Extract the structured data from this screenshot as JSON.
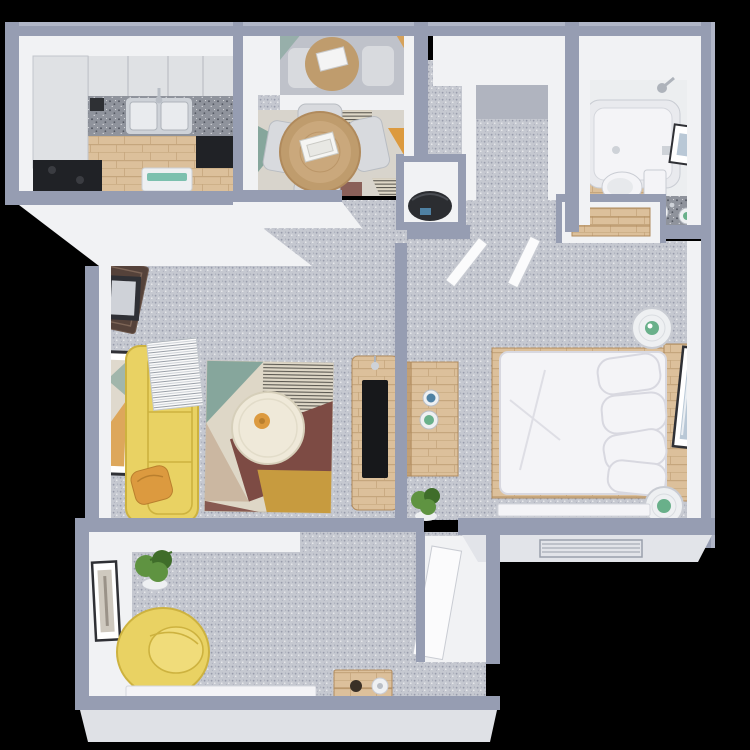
{
  "scene": {
    "title": "Top-down 3D render of a one-bedroom apartment floor plan on a black background",
    "view": "3D dollhouse / top-down",
    "rooms": [
      {
        "name": "Kitchen",
        "floor": "wood",
        "furniture": [
          "upper cabinets",
          "tall cabinet",
          "granite countertop",
          "double stainless sink with faucet",
          "black range",
          "black dishwasher",
          "white bench with teal accent"
        ]
      },
      {
        "name": "Dining Nook",
        "floor": "carpet with wood border",
        "furniture": [
          "round rattan dining table",
          "white books on table",
          "four light gray chairs",
          "geometric flat-weave rug",
          "wall mirror reflecting the dining set"
        ]
      },
      {
        "name": "Hall / Walk-in Closet",
        "floor": "carpet",
        "furniture": [
          "walk-in closet opening",
          "utility closet with dark water heater"
        ]
      },
      {
        "name": "Bathroom",
        "floor": "white with wood section",
        "furniture": [
          "bathtub",
          "shower head",
          "toilet",
          "granite vanity with two green-bowl sinks",
          "vanity lights",
          "framed artwork"
        ]
      },
      {
        "name": "Living Room",
        "floor": "carpet",
        "furniture": [
          "yellow sofa",
          "white striped throw blanket",
          "orange accent pillow",
          "geometric area rug",
          "round cream coffee table with orange decor",
          "wood TV stand with flat TV and candlestick",
          "open entry door",
          "dark welcome mat",
          "two framed artworks"
        ]
      },
      {
        "name": "Bedroom",
        "floor": "carpet",
        "furniture": [
          "white double bed with wood frame and headboard",
          "white pillows",
          "round nightstand with plant (top)",
          "round nightstand with plant (bottom)",
          "wood dresser with blue and green cups",
          "potted plant",
          "tilted framed artwork",
          "two open white doors",
          "closet with wood shelves",
          "white baseboard heater",
          "exterior wall vent"
        ]
      },
      {
        "name": "Den / Sunroom",
        "floor": "carpet",
        "furniture": [
          "yellow swivel chair",
          "potted plant in white pot",
          "tall framed artwork",
          "wood crate side table with paper roll",
          "white baseboard",
          "closet with open white door"
        ]
      }
    ]
  },
  "colors": {
    "bg": "#000000",
    "wall_slate": "#969db2",
    "wall_slate_light": "#b0b6c7",
    "wall_white": "#f1f2f4",
    "wall_shadow": "#d9dbe1",
    "carpet_base": "#c5c8d0",
    "carpet_dot": "#989cab",
    "carpet_dark": "#b0b4bf",
    "wood_base": "#dcc09b",
    "wood_line": "#c5a67d",
    "wood_dark": "#b08a5c",
    "granite_base": "#8f939c",
    "granite_dot": "#565a64",
    "cabinet": "#dfe1e4",
    "cabinet_line": "#c2c5cb",
    "appliance_black": "#202226",
    "steel": "#ced2d8",
    "sofa_yellow": "#e9d263",
    "sofa_shadow": "#cdb23f",
    "pillow_orange": "#dc9a3f",
    "rug_teal": "#86a69c",
    "rug_maroon": "#7d4b44",
    "rug_tan": "#cbb7a1",
    "rug_mustard": "#c79b3f",
    "rug_cream": "#ded7c7",
    "rug_stripe": "#45433d",
    "table_cream": "#efe9d9",
    "rattan": "#bf9c6d",
    "tv_black": "#17181b",
    "plant_green": "#5f9341",
    "plant_dark": "#3f6d2a",
    "bed_white": "#f4f4f7",
    "bed_shadow": "#d8d8e0",
    "frame_dark": "#2f3035",
    "mat_brown": "#55423a",
    "teal_accent": "#7cc0ae",
    "cup_blue": "#4f81a3",
    "pot_white": "#eef0f2",
    "art_blue": "#b9c8d6",
    "heater_dark": "#2b2d31",
    "vanity_green": "#69b08a"
  }
}
